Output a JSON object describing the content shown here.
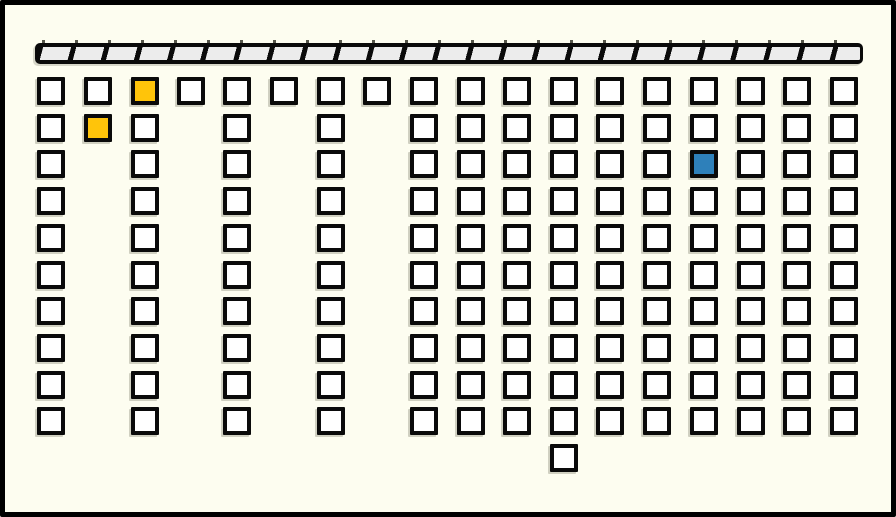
{
  "canvas": {
    "width": 896,
    "height": 517,
    "background_color": "#FDFDF0",
    "frame_color": "#000000"
  },
  "hatched_bar": {
    "x": 35,
    "y": 43,
    "width": 828,
    "height": 21,
    "stripe_light_color": "#ECECEC",
    "stripe_dark_color": "#0A0A0A",
    "stripe_period": 32,
    "stripe_dark_width": 5,
    "stripe_angle_deg": 105
  },
  "board": {
    "square_size": 28,
    "origin_y": 77,
    "row_spacing": 36.7,
    "square_fill_color": "#FFFFFF",
    "square_border_color": "#0A0A0A",
    "columns": [
      {
        "x": 37,
        "rows": 10
      },
      {
        "x": 84,
        "rows": 2
      },
      {
        "x": 131,
        "rows": 10
      },
      {
        "x": 177,
        "rows": 1
      },
      {
        "x": 223,
        "rows": 10
      },
      {
        "x": 270,
        "rows": 1
      },
      {
        "x": 317,
        "rows": 10
      },
      {
        "x": 363,
        "rows": 1
      },
      {
        "x": 410,
        "rows": 10
      },
      {
        "x": 457,
        "rows": 10
      },
      {
        "x": 503,
        "rows": 10
      },
      {
        "x": 550,
        "rows": 11
      },
      {
        "x": 596,
        "rows": 10
      },
      {
        "x": 643,
        "rows": 10
      },
      {
        "x": 690,
        "rows": 10
      },
      {
        "x": 737,
        "rows": 10
      },
      {
        "x": 783,
        "rows": 10
      },
      {
        "x": 830,
        "rows": 10
      }
    ],
    "highlighted_squares": [
      {
        "col": 2,
        "row": 0,
        "color": "#FFC40A",
        "name": "yellow-square-top-row"
      },
      {
        "col": 1,
        "row": 1,
        "color": "#FFC40A",
        "name": "yellow-square-second-row"
      },
      {
        "col": 14,
        "row": 2,
        "color": "#2E80BA",
        "name": "blue-square"
      }
    ],
    "counts": {
      "total_squares": 146,
      "yellow_squares": 2,
      "blue_squares": 1,
      "white_squares": 143,
      "columns": 18,
      "max_rows": 11
    }
  }
}
